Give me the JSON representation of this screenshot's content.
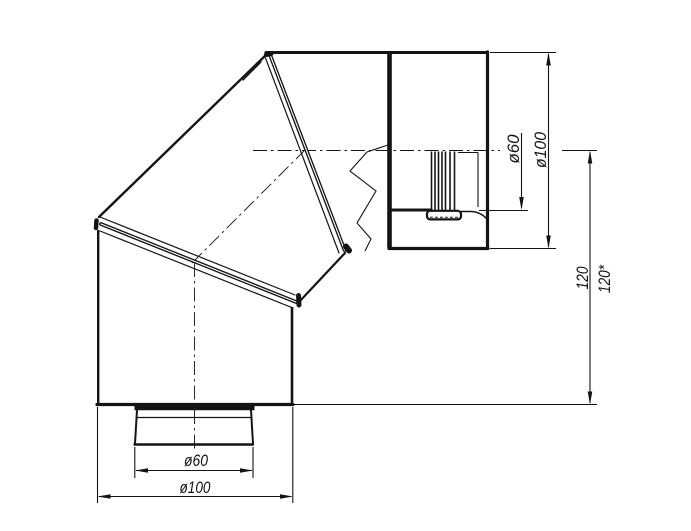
{
  "page": {
    "background": "#ffffff",
    "width": 691,
    "height": 531
  },
  "drawing": {
    "title": "90-degree segmented pipe elbow, side view",
    "ink_color": "#141414",
    "labels": {
      "right_inner_diameter": "ø60",
      "right_outer_diameter": "ø100",
      "height_nominal": "120",
      "height_starred": "120*",
      "bottom_inner_diameter": "ø60",
      "bottom_outer_diameter": "ø100"
    }
  }
}
